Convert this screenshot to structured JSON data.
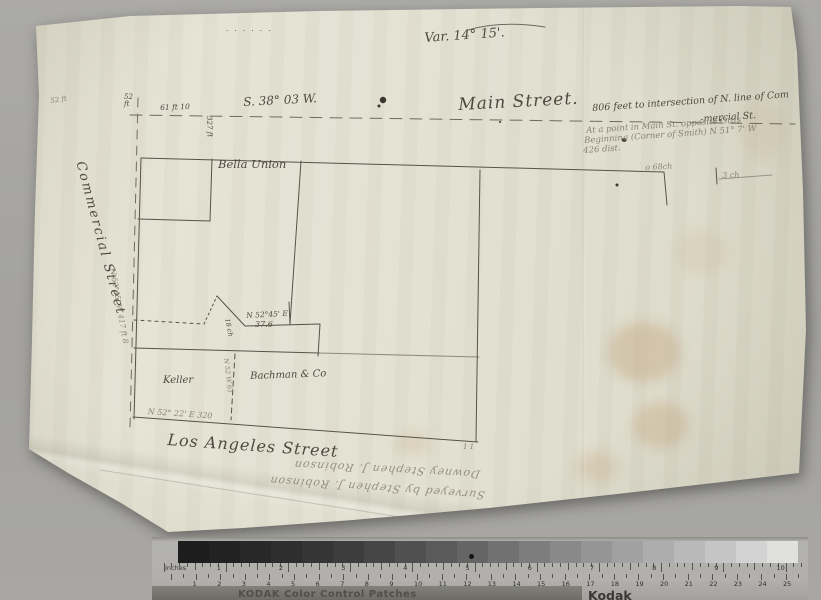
{
  "document": {
    "variation_note": "Var. 14° 15'.",
    "dots_row": "· · · · · ·",
    "bearing_main": "S. 38° 03 W.",
    "street_main": "Main Street.",
    "annotation_line1": "806 feet to intersection of N. line of Com",
    "annotation_line2": "-mercial St.",
    "pencil_note1": "At a point in Main St. opposite Ords",
    "pencil_note2": "Beginning (Corner of Smith) N 51° 7' W",
    "pencil_note3": "426 dist.",
    "far_left_mark": "52 ft",
    "corner_52": "52",
    "corner_ft": "ft",
    "dim_61ft": "61 ft 10",
    "dim_327ft": "327 ft",
    "parcel_bella_union": "Bella Union",
    "street_commercial": "Commercial Street",
    "pencil_west_line": "N 52°45' W  417 ft 8",
    "dim_68ch": "o 68ch",
    "dim_3ch": "3 ch",
    "bearing_mid": "N 52°45' E",
    "dim_376": "37.6",
    "dim_18ch": "18 ch",
    "parcel_keller": "Keller",
    "parcel_bachman": "Bachman & Co",
    "division_bearing": "N 52 W 61",
    "bottom_bearing": "N 52° 22' E 320",
    "street_los_angeles": "Los Angeles Street",
    "marks_11": "1 1",
    "signature_line1": "Downey  Stephen J. Robinson",
    "signature_line2": "Surveyed by Stephen J. Robinson"
  },
  "ruler": {
    "inches_label": "Inches",
    "cm_label": "Centimetres",
    "inch_numbers": [
      1,
      2,
      3,
      4,
      5,
      6,
      7,
      8,
      9,
      10
    ],
    "cm_numbers": [
      1,
      2,
      3,
      4,
      5,
      6,
      7,
      8,
      9,
      10,
      11,
      12,
      13,
      14,
      15,
      16,
      17,
      18,
      19,
      20,
      21,
      22,
      23,
      24,
      25
    ],
    "strip_text": "KODAK Color Control Patches",
    "kodak_logo": "Kodak",
    "wedge_grays": [
      "#1d1d1d",
      "#222222",
      "#282828",
      "#2e2e2e",
      "#353535",
      "#3d3d3d",
      "#464646",
      "#505050",
      "#5a5a5a",
      "#656565",
      "#717171",
      "#7d7d7d",
      "#898989",
      "#959595",
      "#a1a1a1",
      "#adadad",
      "#b9b9b9",
      "#c5c5c5",
      "#d3d3d3",
      "#e0e0de"
    ]
  },
  "colors": {
    "ink": "#4f4a40",
    "pencil": "#8a8376",
    "paper": "#e3e1d2",
    "background": "#a3a29e",
    "stain": "#c2a57e"
  }
}
